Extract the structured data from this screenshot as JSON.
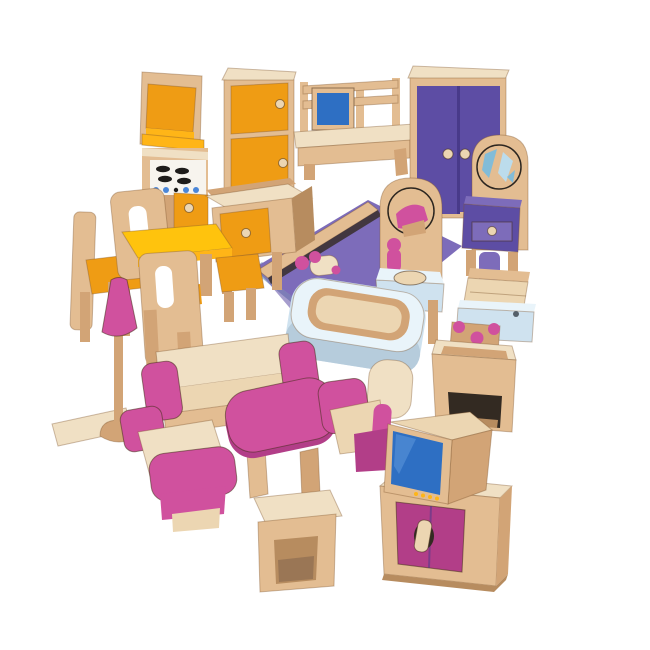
{
  "scene": {
    "title": "Wooden dollhouse furniture set on white background",
    "background": "#ffffff",
    "palette": {
      "background": "#ffffff",
      "wood": "#e3bd92",
      "wood_light": "#f0e0c4",
      "wood_mid": "#d2a476",
      "wood_dark": "#b78c5f",
      "wood_pale": "#ecd6b2",
      "orange": "#ef9c14",
      "orange_bright": "#ffb517",
      "yellow": "#ffc30d",
      "pink": "#d0519e",
      "pink_dark": "#b23e88",
      "purple": "#5d4da4",
      "purple_light": "#7d6cba",
      "purple_dark": "#483a8a",
      "screen_blue": "#2e6fc3",
      "light_blue": "#cfe2ef",
      "light_blue_top": "#e9f4fa",
      "light_blue_shade": "#b6ccdc",
      "slate_blue": "#a4b9cf",
      "shadow_dark": "#332a22",
      "burner_black": "#1e1c1a",
      "mirror_white": "#f5fafc",
      "mirror_shard_blue": "#bcdcec",
      "mirror_shard_teal": "#82bcd8",
      "stove_knob_blue": "#4a86d8",
      "doll_pink": "#d0519e"
    },
    "items": {
      "oven_unit": {
        "label": "toy kitchen oven unit with orange microwave door, black burners and blue knobs"
      },
      "fridge": {
        "label": "toy fridge cabinet with two orange doors"
      },
      "desk": {
        "label": "toy desk with blue computer screen"
      },
      "wardrobe": {
        "label": "toy wardrobe with purple double doors"
      },
      "bed": {
        "label": "toy double bed with purple cover and pink finial"
      },
      "doll": {
        "label": "small wooden peg doll with pink head"
      },
      "dressing_table": {
        "label": "toy dressing table with round mirror and purple drawer"
      },
      "washbasin": {
        "label": "toy washbasin with round mirror, pink tap and pale blue basin"
      },
      "toilet": {
        "label": "toy toilet with pale blue base and wooden lid"
      },
      "sink_counter": {
        "label": "toy kitchen counter cabinet with orange door"
      },
      "dining_table": {
        "label": "toy dining table with yellow top"
      },
      "chair_side": {
        "label": "toy dining chair seen from the side with orange seat"
      },
      "chair_back_left": {
        "label": "toy dining chair with cut-out back"
      },
      "chair_center": {
        "label": "toy dining chair facing away with slot cut-out"
      },
      "chair_right": {
        "label": "toy dining chair with orange seat"
      },
      "nightstand": {
        "label": "toy bedside cabinet with pink hooks"
      },
      "bathtub": {
        "label": "toy bathtub, pale blue with wooden interior"
      },
      "floor_board": {
        "label": "small wooden board"
      },
      "floor_lamp": {
        "label": "toy floor lamp with pink shade"
      },
      "sofa": {
        "label": "toy sofa with pink armrests"
      },
      "armchair_left": {
        "label": "toy armchair with pink armrests, front view"
      },
      "coffee_table": {
        "label": "toy coffee table with pink top"
      },
      "armchair_right": {
        "label": "toy armchair with pink armrests beside the TV"
      },
      "tv_cabinet": {
        "label": "toy TV cabinet with pink doors and wooden handle"
      },
      "tv": {
        "label": "toy television with blue screen"
      },
      "stool": {
        "label": "toy wooden stool"
      }
    }
  }
}
